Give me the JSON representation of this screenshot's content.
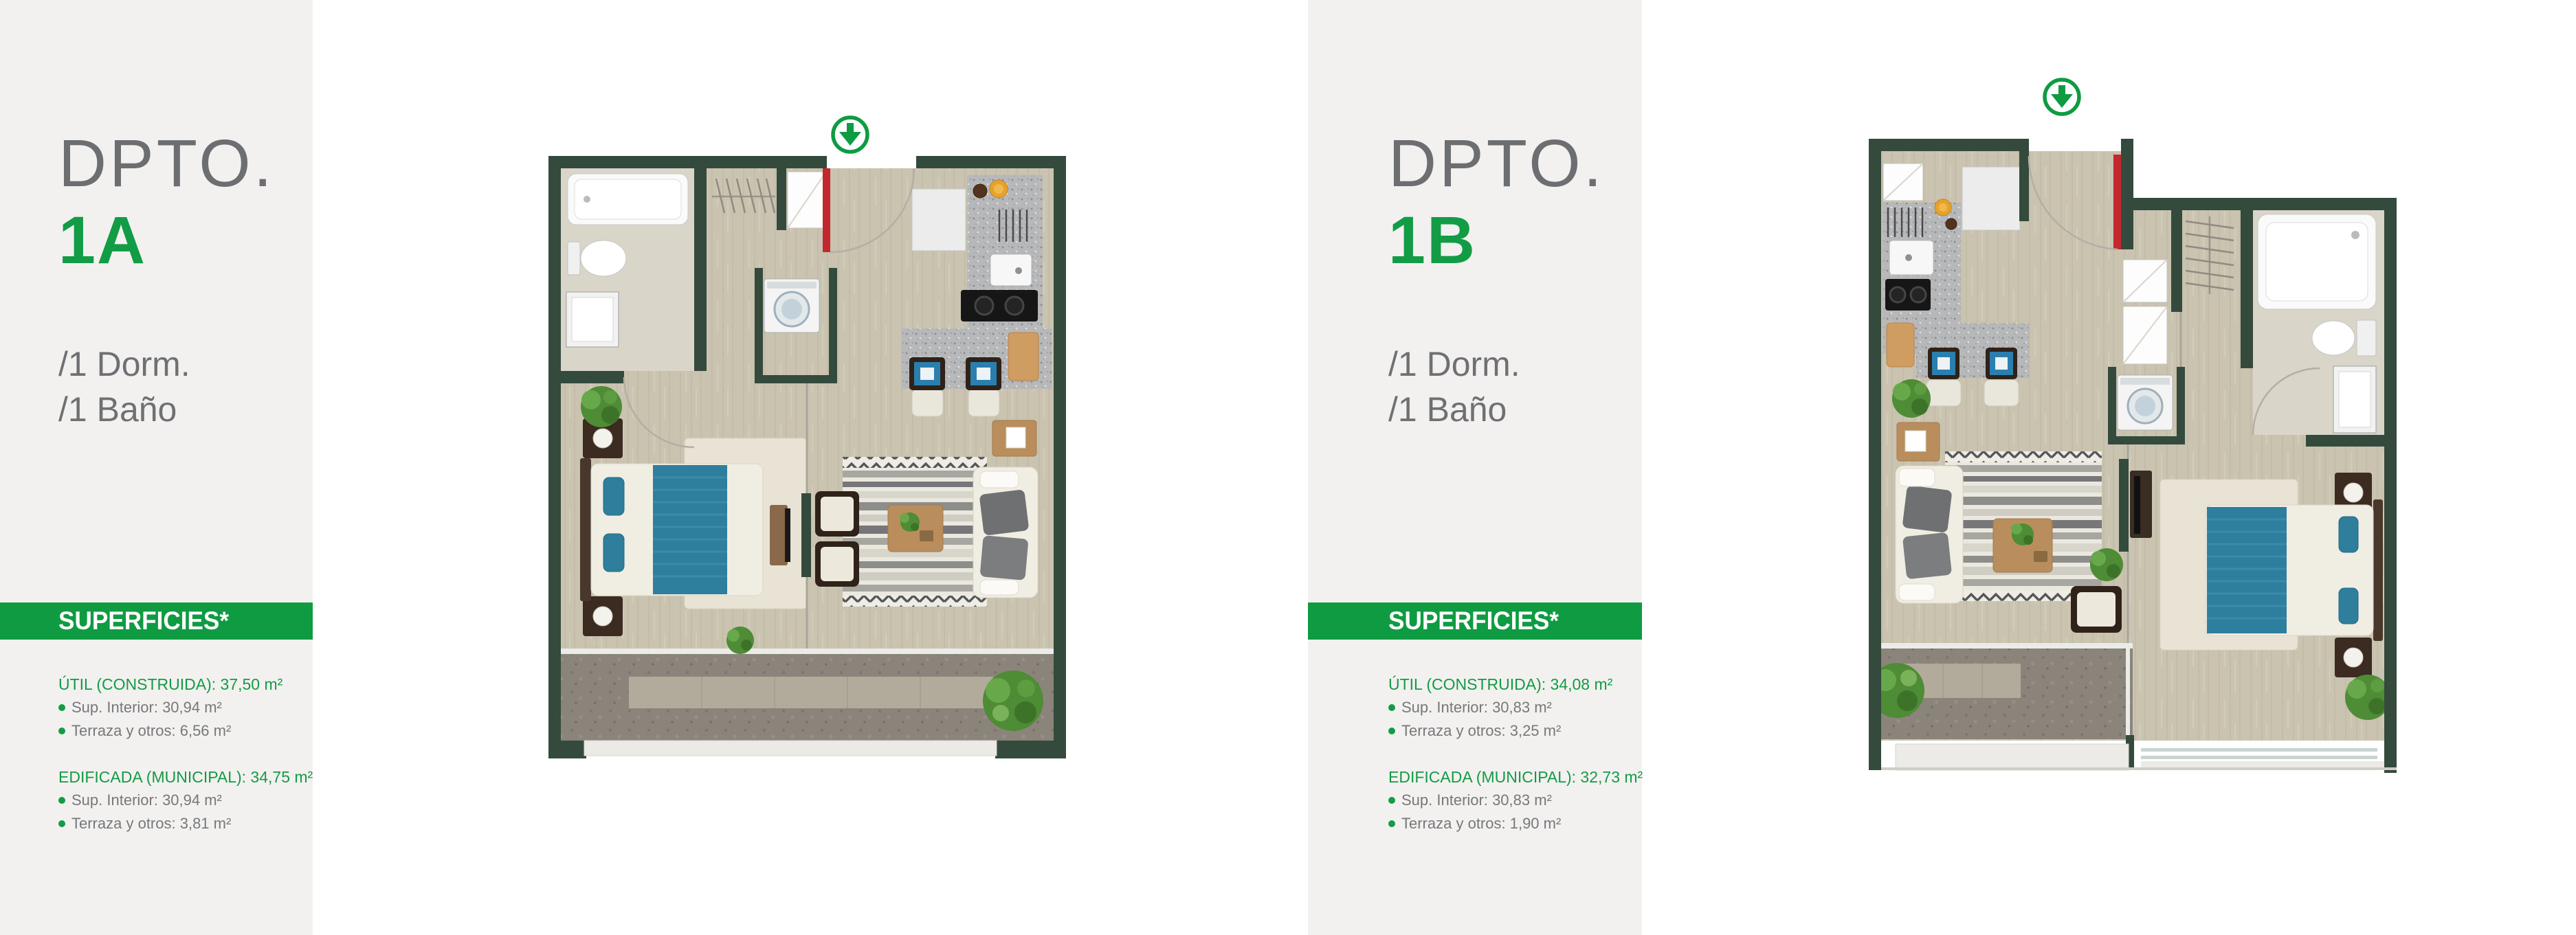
{
  "page": {
    "background": "#ffffff",
    "panel_background": "#f2f1ef"
  },
  "colors": {
    "brand_green": "#0f9b42",
    "number_green": "#129c45",
    "wall_green": "#344a3d",
    "title_gray": "#6d6e71",
    "text_gray": "#77787b"
  },
  "icons": {
    "orientation": "circle-down-arrow-icon"
  },
  "units": [
    {
      "title": "DPTO.",
      "number": "1A",
      "rooms": [
        "/1 Dorm.",
        "/1 Baño"
      ],
      "superficies_banner": "SUPERFICIES*",
      "groups": [
        {
          "header": "ÚTIL (CONSTRUIDA): 37,50 m²",
          "items": [
            "Sup. Interior: 30,94 m²",
            "Terraza y otros: 6,56 m²"
          ]
        },
        {
          "header": "EDIFICADA (MUNICIPAL): 34,75 m²",
          "items": [
            "Sup. Interior: 30,94 m²",
            "Terraza y otros: 3,81 m²"
          ]
        }
      ]
    },
    {
      "title": "DPTO.",
      "number": "1B",
      "rooms": [
        "/1 Dorm.",
        "/1 Baño"
      ],
      "superficies_banner": "SUPERFICIES*",
      "groups": [
        {
          "header": "ÚTIL (CONSTRUIDA): 34,08 m²",
          "items": [
            "Sup. Interior: 30,83 m²",
            "Terraza y otros: 3,25 m²"
          ]
        },
        {
          "header": "EDIFICADA (MUNICIPAL): 32,73 m²",
          "items": [
            "Sup. Interior: 30,83 m²",
            "Terraza y otros: 1,90 m²"
          ]
        }
      ]
    }
  ]
}
